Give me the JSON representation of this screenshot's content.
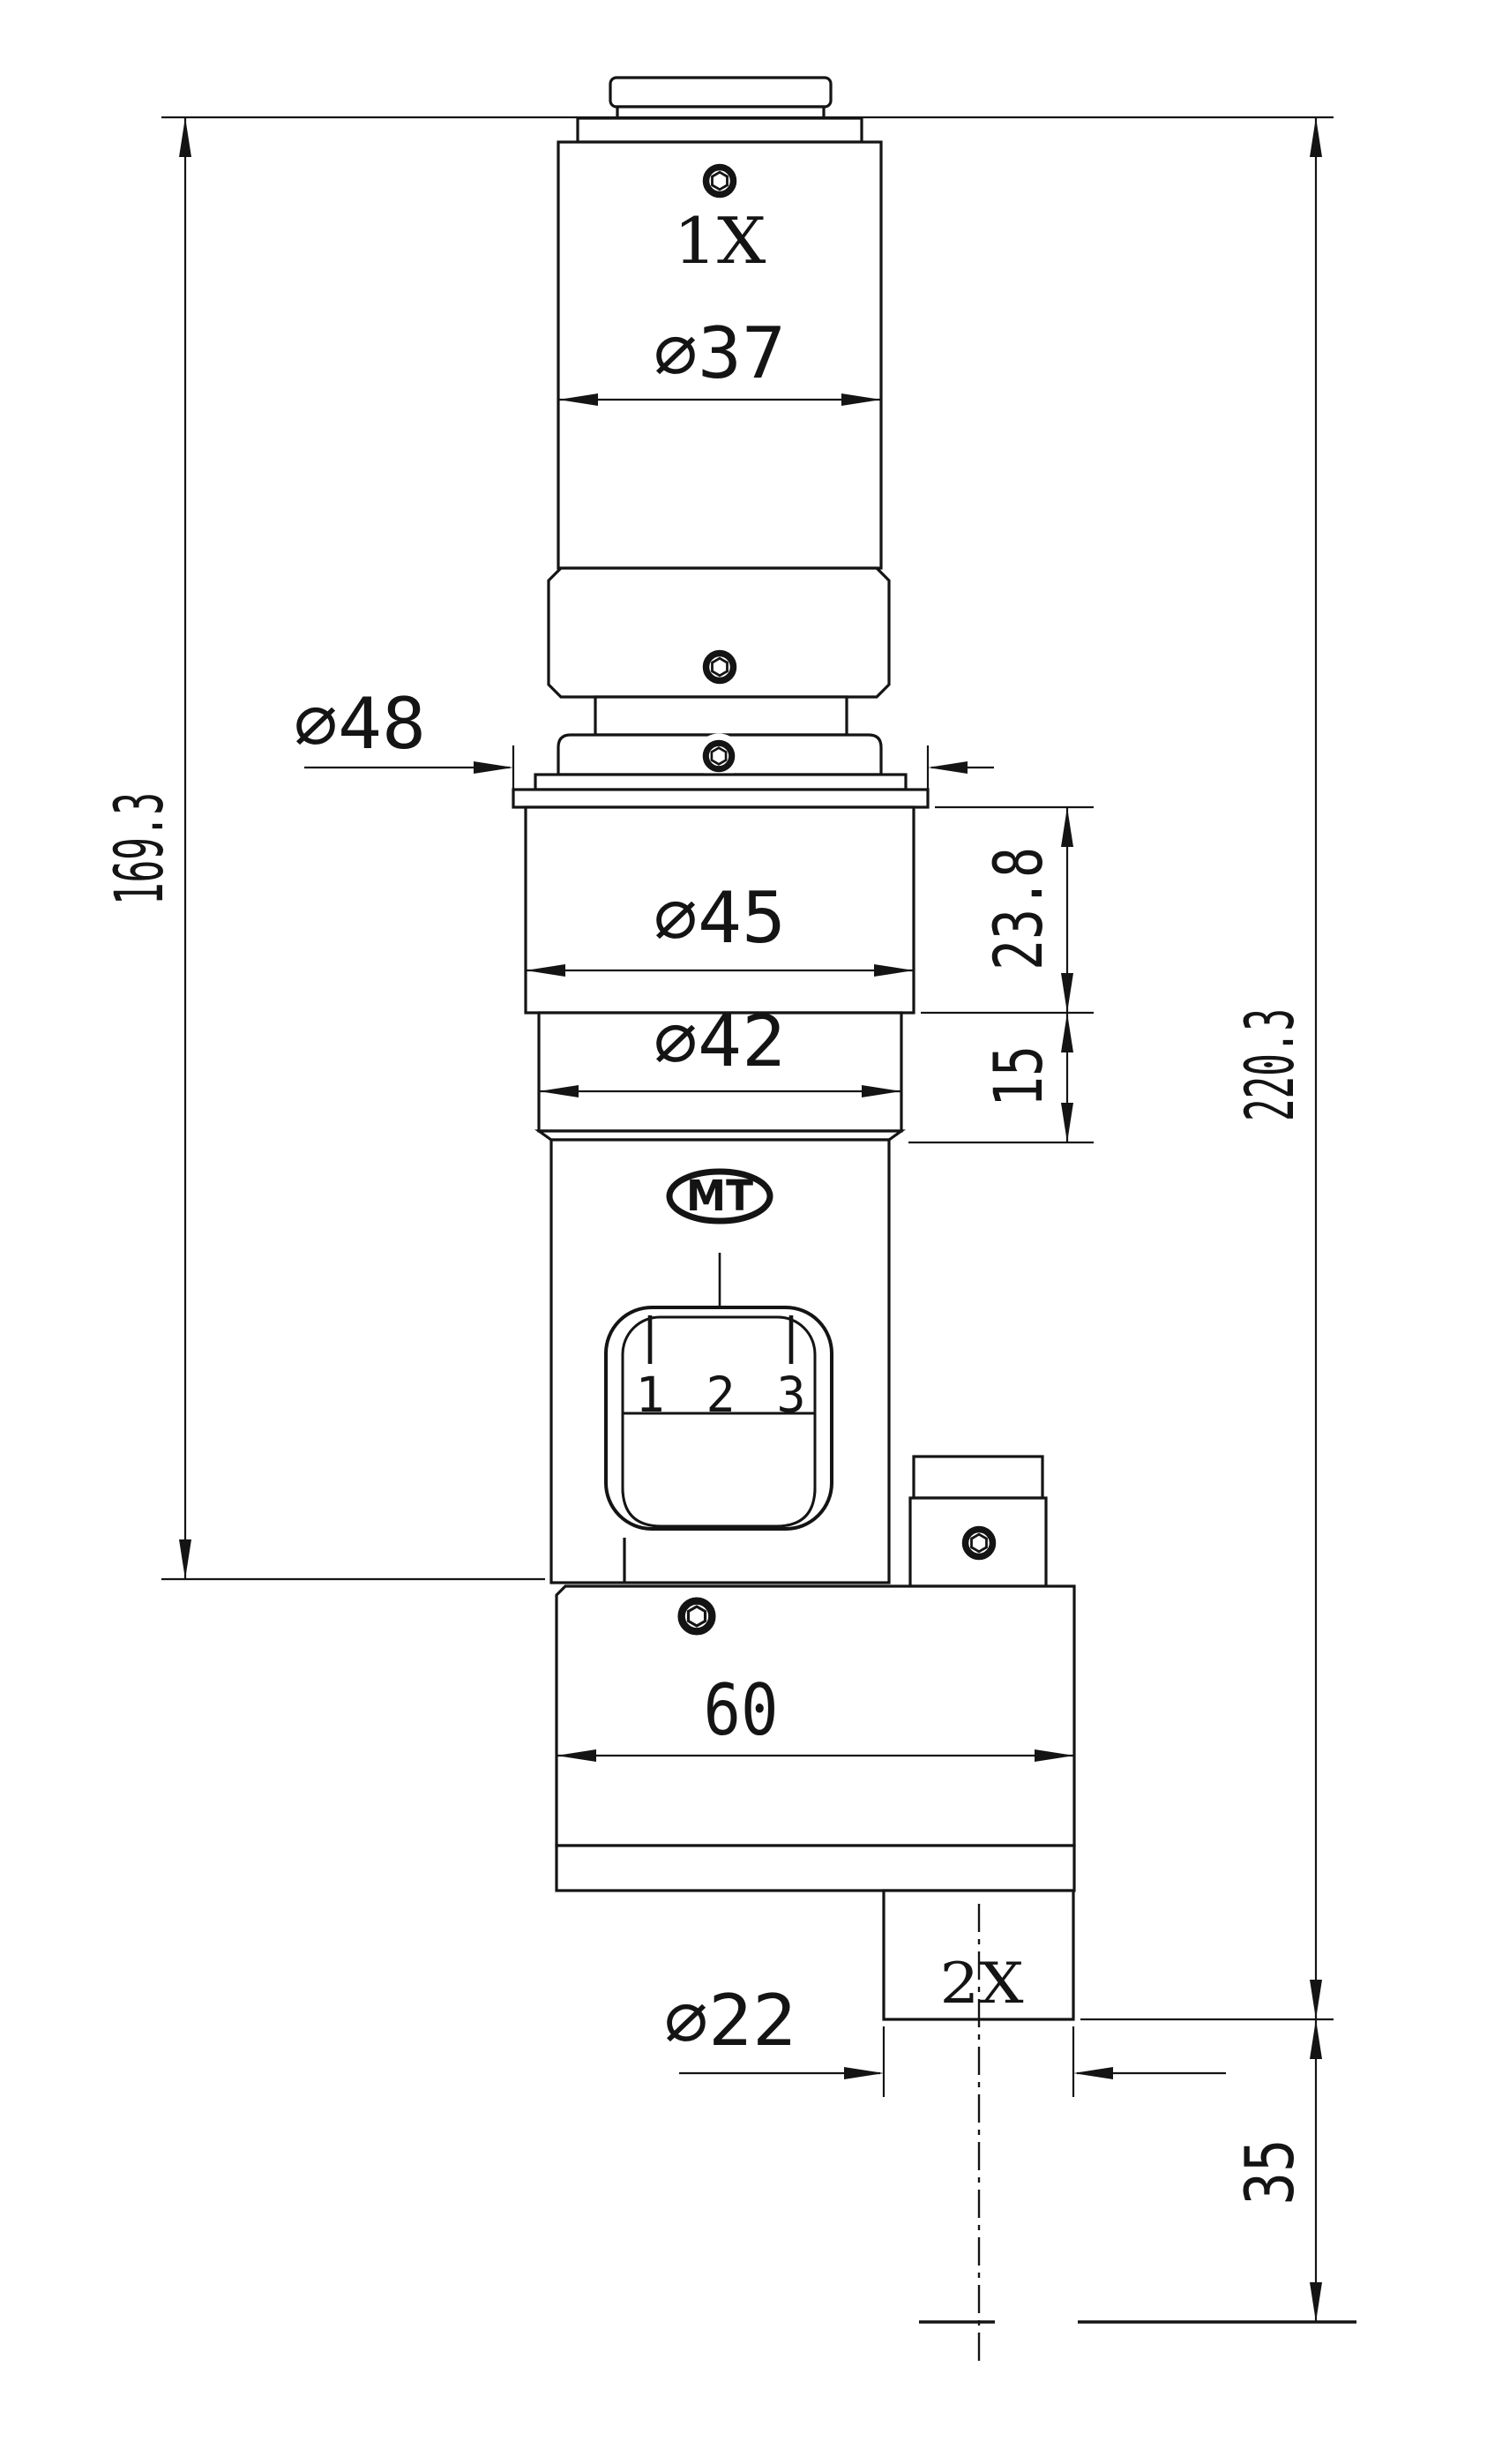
{
  "drawing": {
    "labels": {
      "mag_top": "1X",
      "mag_bottom": "2X",
      "logo": "MT"
    },
    "scale_marks": {
      "m1": "1",
      "m2": "2",
      "m3": "3"
    },
    "dims": {
      "dia37": "∅37",
      "dia48": "∅48",
      "dia45": "∅45",
      "dia42": "∅42",
      "dia22": "∅22",
      "len169": "169.3",
      "len220": "220.3",
      "len238": "23.8",
      "len15": "15",
      "len60": "60",
      "len35": "35"
    },
    "colors": {
      "line": "#141414",
      "background": "#ffffff"
    }
  }
}
